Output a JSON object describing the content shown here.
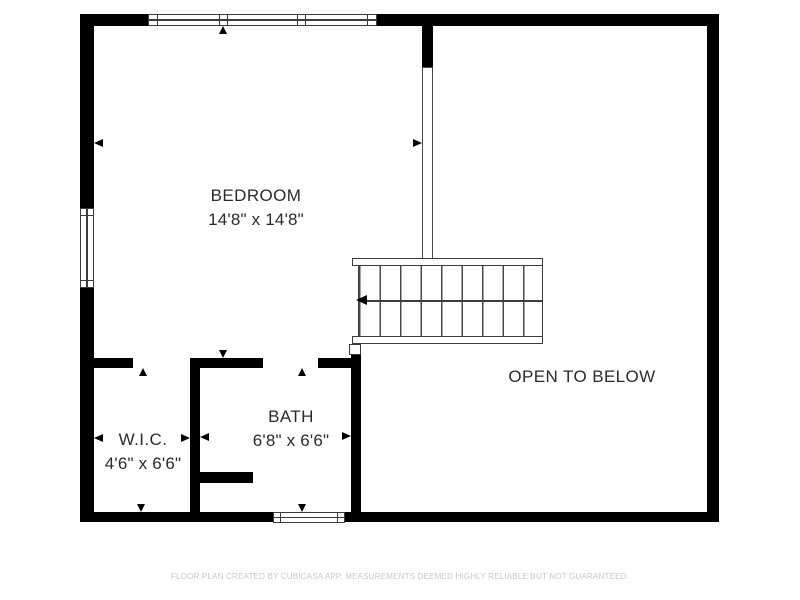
{
  "plan": {
    "rooms": {
      "bedroom": {
        "name": "BEDROOM",
        "dims": "14'8\" x 14'8\""
      },
      "wic": {
        "name": "W.I.C.",
        "dims": "4'6\" x 6'6\""
      },
      "bath": {
        "name": "BATH",
        "dims": "6'8\" x 6'6\""
      },
      "open_to_below": {
        "name": "OPEN TO BELOW"
      }
    },
    "footer": "FLOOR PLAN CREATED BY CUBICASA APP. MEASUREMENTS DEEMED HIGHLY RELIABLE BUT NOT GUARANTEED.",
    "colors": {
      "wall": "#000000",
      "detail_line": "#3c3c3c",
      "label_text": "#2a2a2a",
      "footer_text": "#c8c8c8",
      "background": "#ffffff"
    }
  }
}
